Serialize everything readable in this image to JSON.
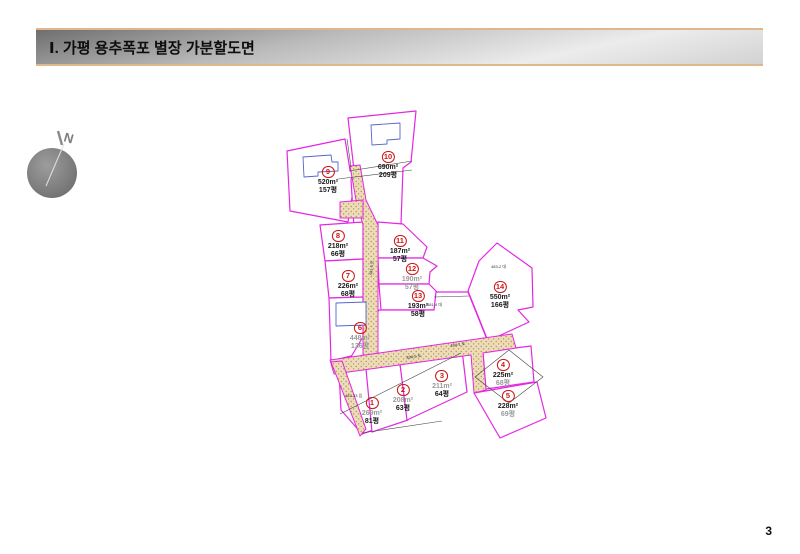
{
  "slide": {
    "title": "Ⅰ. 가평 용추폭포 별장 가분할도면",
    "page_number": "3"
  },
  "compass": {
    "label": "N"
  },
  "map": {
    "lots": [
      {
        "num": "1",
        "area": "269m²",
        "pyeong": "81평"
      },
      {
        "num": "2",
        "area": "208m²",
        "pyeong": "63평"
      },
      {
        "num": "3",
        "area": "211m²",
        "pyeong": "64평"
      },
      {
        "num": "4",
        "area": "225m²",
        "pyeong": "68평"
      },
      {
        "num": "5",
        "area": "228m²",
        "pyeong": "69평"
      },
      {
        "num": "6",
        "area": "448m²",
        "pyeong": "136평"
      },
      {
        "num": "7",
        "area": "226m²",
        "pyeong": "68평"
      },
      {
        "num": "8",
        "area": "218m²",
        "pyeong": "66평"
      },
      {
        "num": "9",
        "area": "520m²",
        "pyeong": "157평"
      },
      {
        "num": "10",
        "area": "690m²",
        "pyeong": "209평"
      },
      {
        "num": "11",
        "area": "187m²",
        "pyeong": "57평"
      },
      {
        "num": "12",
        "area": "190m²",
        "pyeong": "57평"
      },
      {
        "num": "13",
        "area": "193m²",
        "pyeong": "58평"
      },
      {
        "num": "14",
        "area": "550m²",
        "pyeong": "166평"
      }
    ],
    "parcel_labels": [
      {
        "text": "483-2 대"
      },
      {
        "text": "481-4 대"
      },
      {
        "text": "481-3 도"
      },
      {
        "text": "484-5 도"
      },
      {
        "text": "484-1 도"
      },
      {
        "text": "483-23 임"
      }
    ]
  },
  "colors": {
    "parcel_line": "#e327e3",
    "road_fill": "#ecddb8",
    "building_line": "#5566cc",
    "lot_number": "#cc1515",
    "header_border": "#dfb68e"
  }
}
